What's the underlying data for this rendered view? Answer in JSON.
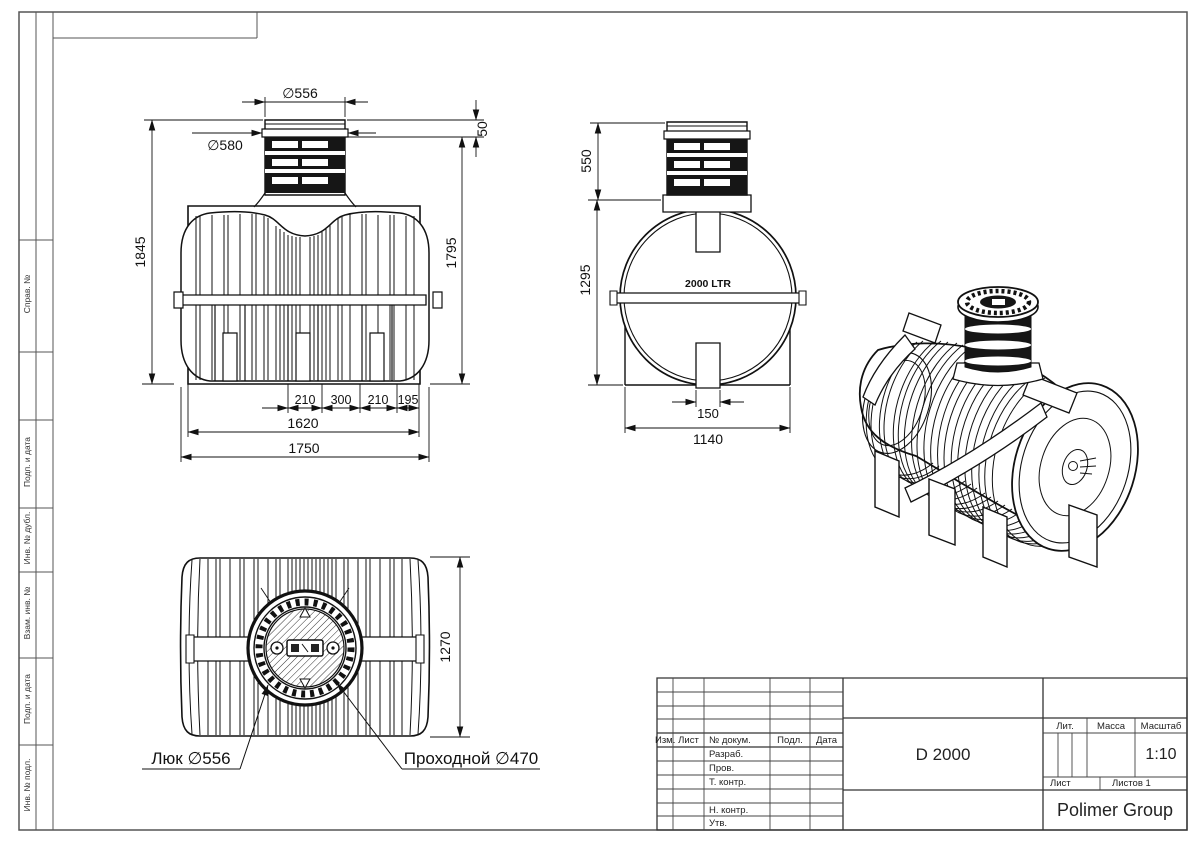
{
  "margin": {
    "labels": [
      "Справ. №",
      "Подп. и дата",
      "Инв. № дубл.",
      "Взам. инв. №",
      "Подп. и дата",
      "Инв. № подл."
    ]
  },
  "views": {
    "front": {
      "dia_top": "∅556",
      "dia_flange": "∅580",
      "lip_height": "50",
      "total_height": "1845",
      "body_height": "1795",
      "seg_1": "210",
      "seg_2": "300",
      "seg_3": "210",
      "seg_4": "195",
      "frame_width": "1620",
      "total_width": "1750"
    },
    "side": {
      "neck_height": "550",
      "body_height": "1295",
      "volume_label": "2000 LTR",
      "foot_width": "150",
      "base_width": "1140"
    },
    "top": {
      "body_width": "1270",
      "callout_hatch": "Люк ∅556",
      "callout_pass": "Проходной ∅470"
    }
  },
  "title_block": {
    "designation": "D 2000",
    "company": "Polimer Group",
    "scale_value": "1:10",
    "header": {
      "izm": "Изм.",
      "list": "Лист",
      "doc": "№ докум.",
      "sign": "Подл.",
      "date": "Дата"
    },
    "rows": [
      "Разраб.",
      "Пров.",
      "Т. контр.",
      "",
      "Н. контр.",
      "Утв."
    ],
    "labels": {
      "lit": "Лит.",
      "mass": "Масса",
      "scale": "Масштаб",
      "sheet": "Лист",
      "sheets": "Листов 1"
    }
  }
}
